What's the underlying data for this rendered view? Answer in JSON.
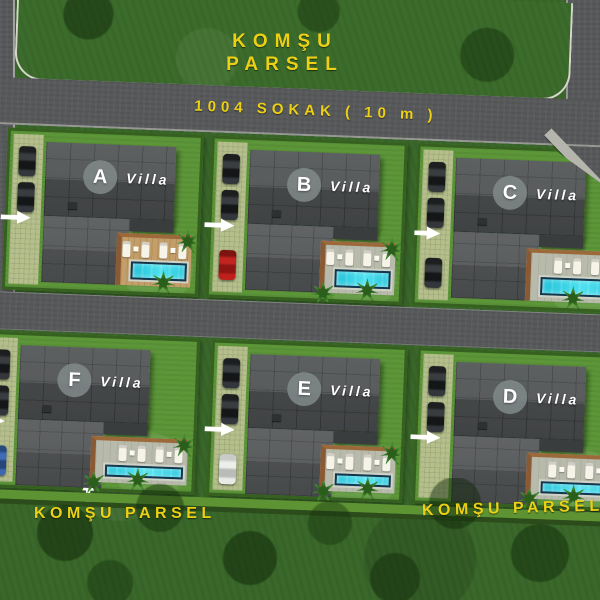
{
  "labels": {
    "top_parcel": {
      "line1": "KOMŞU",
      "line2": "PARSEL"
    },
    "street": "1004 SOKAK ( 10 m )",
    "bottom_left_parcel": "KOMŞU PARSEL",
    "bottom_right_parcel": "KOMŞU PARSEL"
  },
  "villas": [
    {
      "letter": "A",
      "name": "Villa",
      "row": "top",
      "position": 1,
      "cars": [
        "dark",
        "dark"
      ]
    },
    {
      "letter": "B",
      "name": "Villa",
      "row": "top",
      "position": 2,
      "cars": [
        "dark",
        "dark",
        "red"
      ]
    },
    {
      "letter": "C",
      "name": "Villa",
      "row": "top",
      "position": 3,
      "cars": [
        "dark",
        "dark",
        "dark"
      ]
    },
    {
      "letter": "F",
      "name": "Villa",
      "row": "bottom",
      "position": 1,
      "cars": [
        "dark",
        "dark",
        "blue"
      ]
    },
    {
      "letter": "E",
      "name": "Villa",
      "row": "bottom",
      "position": 2,
      "cars": [
        "dark",
        "dark",
        "white"
      ]
    },
    {
      "letter": "D",
      "name": "Villa",
      "row": "bottom",
      "position": 3,
      "cars": [
        "dark",
        "dark"
      ]
    }
  ],
  "icons": {
    "entrance_arrow": "→",
    "palm_tree": "✳"
  },
  "colors": {
    "label_yellow": "#ecd016",
    "road_gray": "#57595a",
    "roof_gray": "#4e5152",
    "pool_cyan": "#35d6e6",
    "deck_stone": "#b8baab",
    "deck_wood": "#c49e69",
    "grass_outer": "#3a682a",
    "grass_plot": "#5c9639"
  }
}
